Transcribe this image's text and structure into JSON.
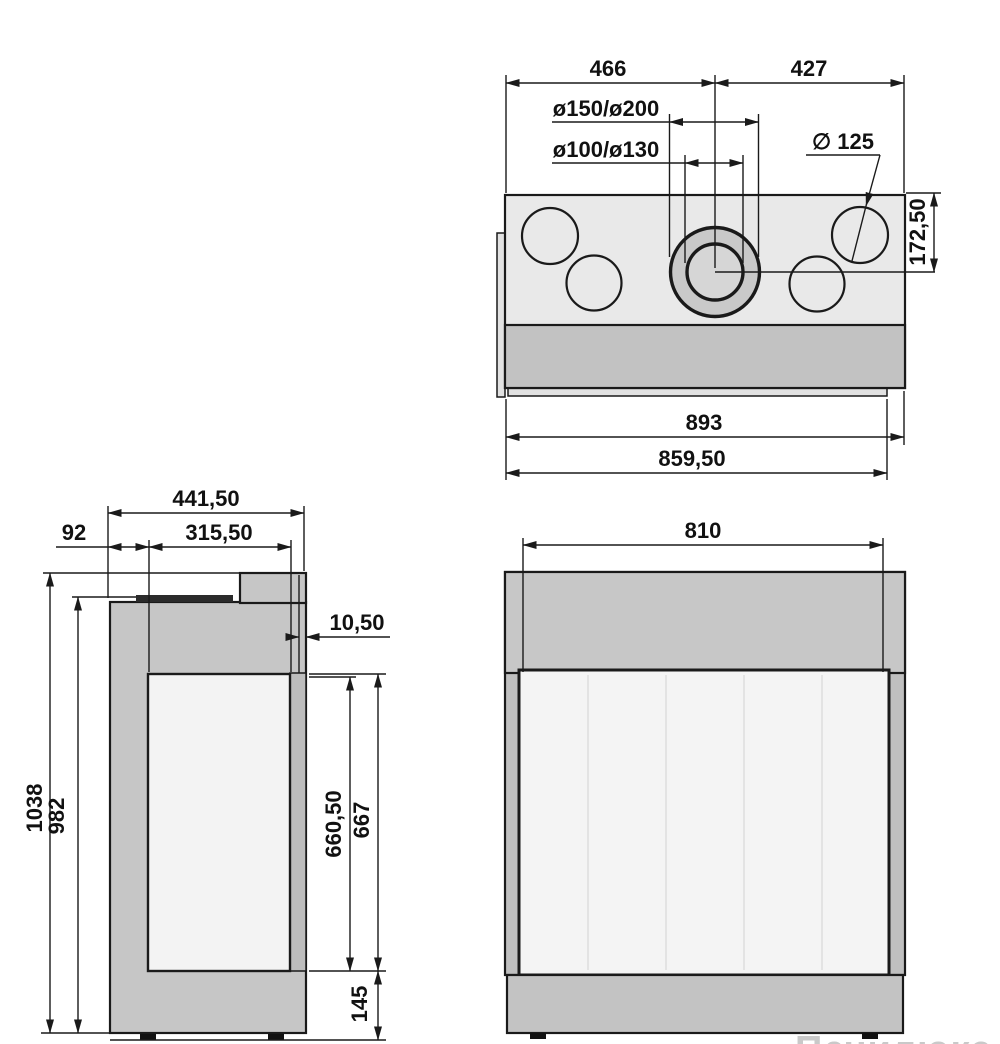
{
  "watermark": "Печилюкс.ру",
  "views": {
    "top": {
      "dims": {
        "left_width": "466",
        "right_width": "427",
        "flue_pipe": "ø150/ø200",
        "air_pipe": "ø100/ø130",
        "outlet_dia": "∅ 125",
        "flue_center_offset": "172,50",
        "overall_width": "893",
        "rear_width": "859,50"
      }
    },
    "side": {
      "dims": {
        "overall_depth": "441,50",
        "rear_offset": "92",
        "mid_depth": "315,50",
        "front_lip": "10,50",
        "overall_height": "1038",
        "body_height": "982",
        "glass_height": "660,50",
        "door_height": "667",
        "base_height": "145"
      }
    },
    "front": {
      "dims": {
        "glass_width": "810"
      }
    }
  }
}
